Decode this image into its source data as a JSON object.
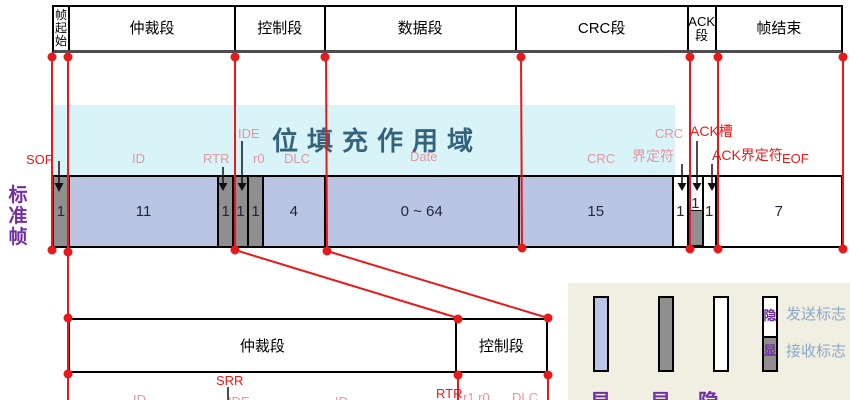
{
  "frame_label": "标准帧",
  "top_segments": [
    "帧起始",
    "仲裁段",
    "控制段",
    "数据段",
    "CRC段",
    "ACK段",
    "帧结束"
  ],
  "stuffing_zone_label": "位填充作用域",
  "field_labels": {
    "sof": "SOF",
    "id": "ID",
    "rtr": "RTR",
    "ide": "IDE",
    "r0": "r0",
    "dlc": "DLC",
    "date": "Date",
    "crc": "CRC",
    "crc_delim_line1": "CRC",
    "crc_delim_line2_pink": "界定",
    "crc_delim_line2_red": "符",
    "ack_slot": "ACK槽",
    "ack_delim": "ACK界定符",
    "eof": "EOF"
  },
  "fields": [
    {
      "name": "SOF",
      "bits": "1",
      "level": "dominant"
    },
    {
      "name": "ID",
      "bits": "11",
      "level": "either"
    },
    {
      "name": "RTR",
      "bits": "1",
      "level": "dominant"
    },
    {
      "name": "IDE",
      "bits": "1",
      "level": "dominant"
    },
    {
      "name": "r0",
      "bits": "1",
      "level": "dominant"
    },
    {
      "name": "DLC",
      "bits": "4",
      "level": "either"
    },
    {
      "name": "Date",
      "bits": "0 ~ 64",
      "level": "either"
    },
    {
      "name": "CRC",
      "bits": "15",
      "level": "either"
    },
    {
      "name": "CRC界定符",
      "bits": "1",
      "level": "recessive"
    },
    {
      "name": "ACK槽",
      "bits": "1",
      "level": "send-recessive-receive-dominant"
    },
    {
      "name": "ACK界定符",
      "bits": "1",
      "level": "recessive"
    },
    {
      "name": "EOF",
      "bits": "7",
      "level": "recessive"
    }
  ],
  "bottom_table": {
    "segments": [
      "仲裁段",
      "控制段"
    ],
    "labels": {
      "srr": "SRR",
      "id_a": "ID",
      "ide": "IDE",
      "id_b": "ID",
      "rtr": "RTR",
      "r1r0": "r1 r0",
      "dlc": "DLC"
    }
  },
  "legend": {
    "send_flag": "发送标志",
    "receive_flag": "接收标志",
    "slot_top_char": "隐",
    "slot_bottom_char": "显",
    "below_chars": [
      "显",
      "显",
      "隐"
    ]
  },
  "colors": {
    "accent_red": "#e61a1a",
    "field_blue": "#b9c5e2",
    "field_gray": "#8f8f8f",
    "stuffing_cyan": "#d9f4f9",
    "stuffing_text": "#36637c",
    "label_pink": "#df98a0",
    "purple": "#7030a0",
    "legend_bg": "#f0efe2",
    "legend_text": "#8ca8cc"
  }
}
